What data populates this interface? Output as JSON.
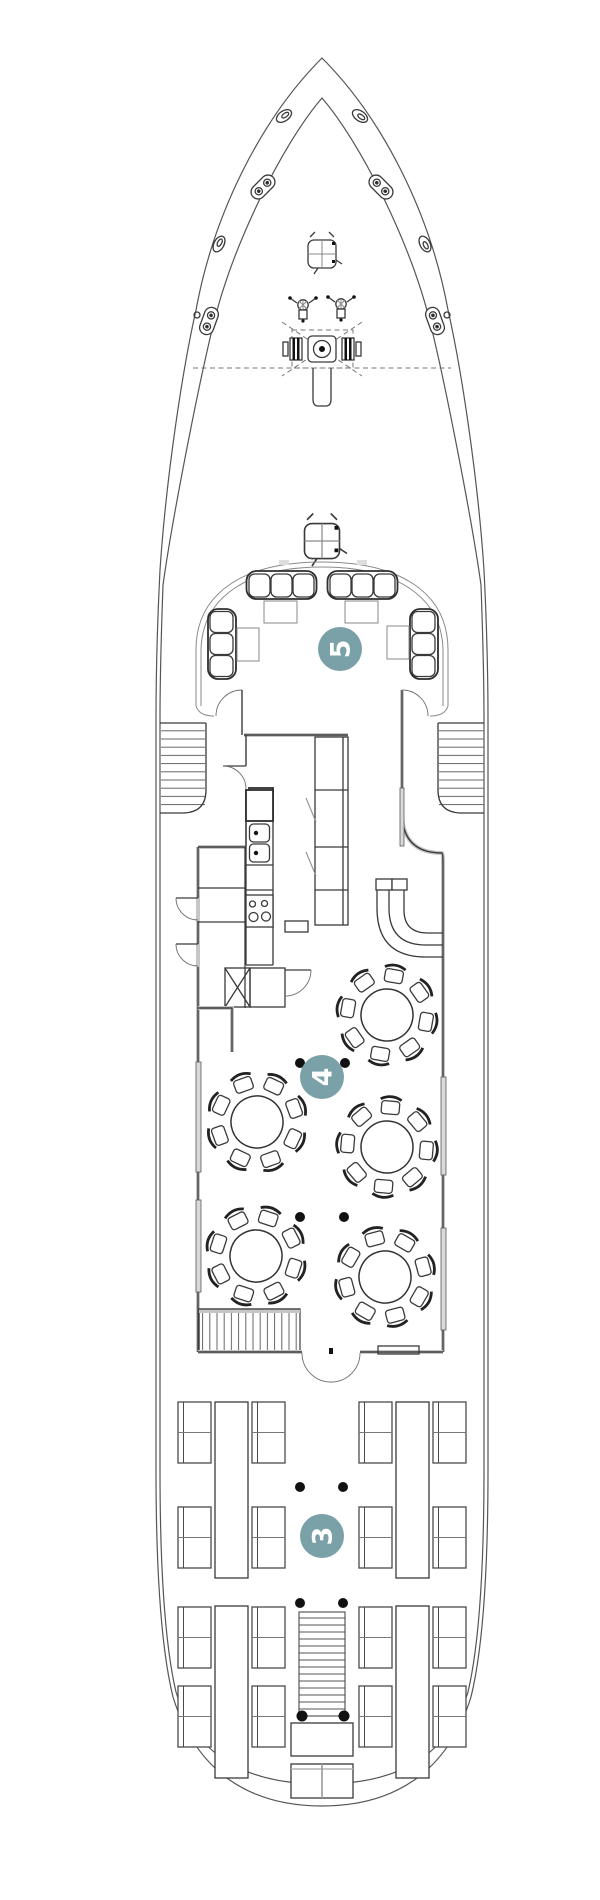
{
  "palette": {
    "badge_fill": "#7aa1a7",
    "badge_text": "#ffffff",
    "pillar": "#111111",
    "line_dark": "#3a3a3a",
    "line_light": "#c6c6c6",
    "window_fill": "#d9d9d9"
  },
  "badges": [
    {
      "id": "deck-5",
      "label": "5"
    },
    {
      "id": "deck-4",
      "label": "4"
    },
    {
      "id": "deck-3",
      "label": "3"
    }
  ]
}
